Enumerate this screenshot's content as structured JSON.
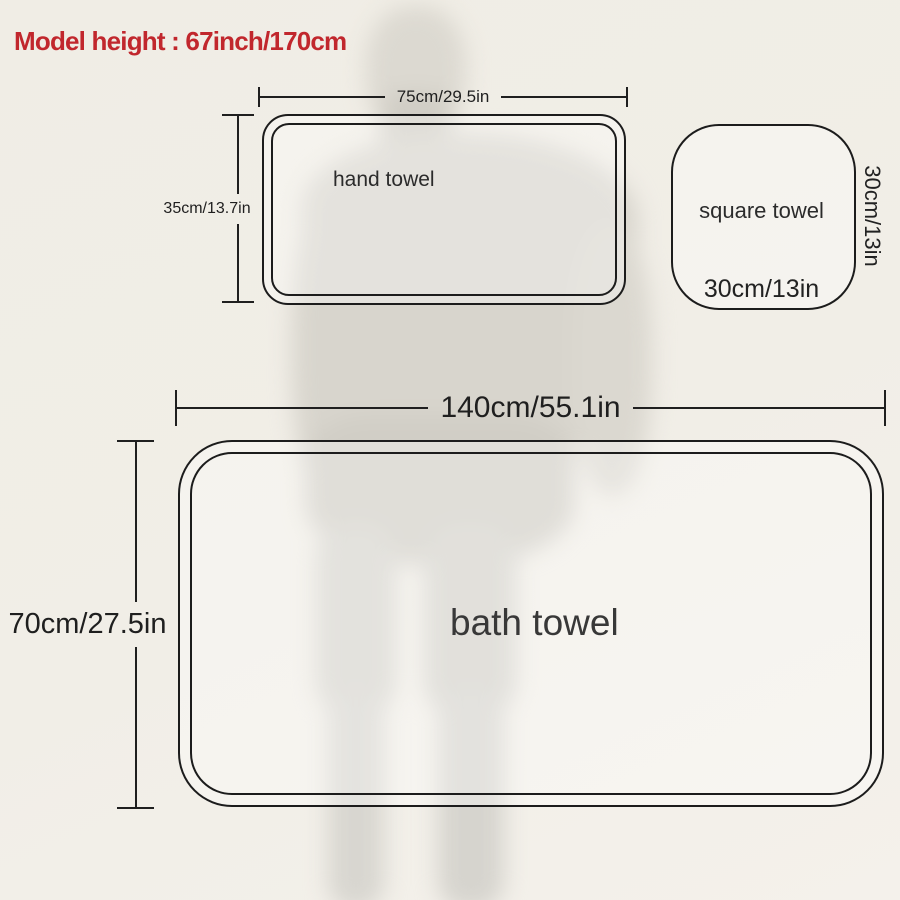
{
  "title": "Model height : 67inch/170cm",
  "hand_towel": {
    "label": "hand towel",
    "width_dim": "75cm/29.5in",
    "height_dim": "35cm/13.7in"
  },
  "square_towel": {
    "label": "square towel",
    "bottom_dim": "30cm/13in",
    "side_dim": "30cm/13in"
  },
  "bath_towel": {
    "label": "bath towel",
    "width_dim": "140cm/55.1in",
    "height_dim": "70cm/27.5in"
  },
  "colors": {
    "accent_red": "#c1272d",
    "line": "#1f1f1f",
    "background": "#f1eee7",
    "silhouette": "#d7d4cc"
  }
}
